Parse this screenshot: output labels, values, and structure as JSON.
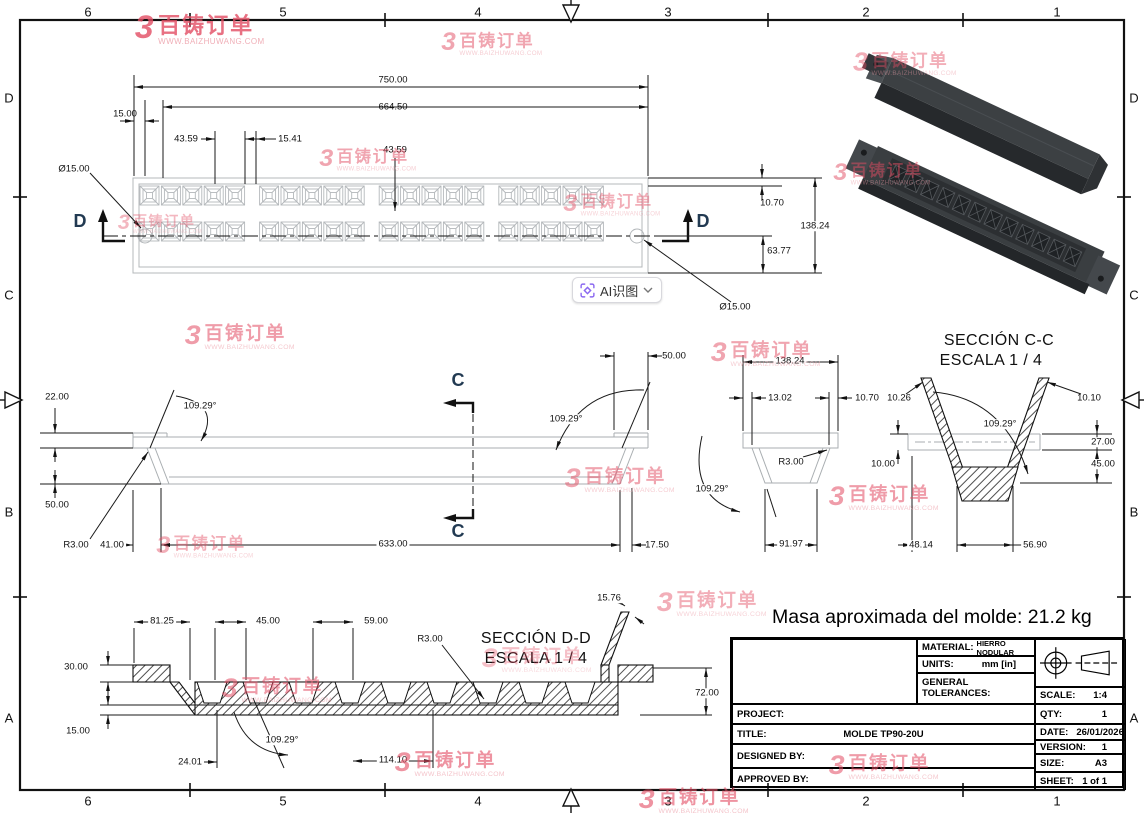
{
  "border": {
    "cols": [
      "6",
      "5",
      "4",
      "3",
      "2",
      "1"
    ],
    "col_x": [
      88,
      283,
      478,
      668,
      866,
      1057
    ],
    "rows": [
      "D",
      "C",
      "B",
      "A"
    ],
    "row_y": [
      98,
      295,
      512,
      718
    ]
  },
  "watermark": {
    "logo": "3",
    "brand": "百铸订单",
    "url": "WWW.BAIZHUWANG.COM",
    "positions": [
      [
        200,
        30,
        1,
        0.8
      ],
      [
        492,
        44,
        0.78,
        0.5
      ],
      [
        905,
        64,
        0.8,
        0.45
      ],
      [
        368,
        160,
        0.75,
        0.5
      ],
      [
        612,
        205,
        0.75,
        0.45
      ],
      [
        882,
        174,
        0.75,
        0.5
      ],
      [
        240,
        337,
        0.85,
        0.55
      ],
      [
        766,
        354,
        0.85,
        0.5
      ],
      [
        620,
        480,
        0.85,
        0.5
      ],
      [
        884,
        498,
        0.85,
        0.55
      ],
      [
        205,
        547,
        0.75,
        0.45
      ],
      [
        712,
        604,
        0.85,
        0.45
      ],
      [
        537,
        660,
        0.85,
        0.35
      ],
      [
        277,
        690,
        0.85,
        0.55
      ],
      [
        450,
        764,
        0.85,
        0.6
      ],
      [
        884,
        767,
        0.85,
        0.55
      ],
      [
        694,
        801,
        0.85,
        0.6
      ],
      [
        160,
        224,
        0.65,
        0.4
      ]
    ]
  },
  "ai_button": {
    "label": "AI识图",
    "icon": "scan-sparkle-icon"
  },
  "mass_note": "Masa aproximada del molde: 21.2 kg",
  "dimensions": [
    {
      "t": "750.00",
      "x": 393,
      "y": 80
    },
    {
      "t": "664.50",
      "x": 393,
      "y": 107
    },
    {
      "t": "15.00",
      "x": 125,
      "y": 114
    },
    {
      "t": "43.59",
      "x": 186,
      "y": 139
    },
    {
      "t": "15.41",
      "x": 290,
      "y": 139
    },
    {
      "t": "43.59",
      "x": 395,
      "y": 150
    },
    {
      "t": "Ø15.00",
      "x": 74,
      "y": 169
    },
    {
      "t": "10.70",
      "x": 772,
      "y": 203
    },
    {
      "t": "138.24",
      "x": 815,
      "y": 226,
      "bg": 1
    },
    {
      "t": "63.77",
      "x": 779,
      "y": 251
    },
    {
      "t": "Ø15.00",
      "x": 735,
      "y": 307
    },
    {
      "t": "D",
      "x": 80,
      "y": 221,
      "cls": "letter"
    },
    {
      "t": "D",
      "x": 703,
      "y": 221,
      "cls": "letter"
    },
    {
      "t": "22.00",
      "x": 57,
      "y": 397
    },
    {
      "t": "109.29°",
      "x": 200,
      "y": 406,
      "bg": 1
    },
    {
      "t": "50.00",
      "x": 57,
      "y": 505
    },
    {
      "t": "R3.00",
      "x": 76,
      "y": 545
    },
    {
      "t": "41.00",
      "x": 112,
      "y": 545,
      "bg": 1
    },
    {
      "t": "633.00",
      "x": 393,
      "y": 544,
      "bg": 1
    },
    {
      "t": "17.50",
      "x": 657,
      "y": 545
    },
    {
      "t": "50.00",
      "x": 674,
      "y": 356
    },
    {
      "t": "109.29°",
      "x": 566,
      "y": 419,
      "bg": 1
    },
    {
      "t": "C",
      "x": 458,
      "y": 380,
      "cls": "letter"
    },
    {
      "t": "C",
      "x": 458,
      "y": 531,
      "cls": "letter"
    },
    {
      "t": "138.24",
      "x": 790,
      "y": 361,
      "bg": 1
    },
    {
      "t": "13.02",
      "x": 780,
      "y": 398
    },
    {
      "t": "10.70",
      "x": 867,
      "y": 398
    },
    {
      "t": "R3.00",
      "x": 791,
      "y": 462,
      "bg": 1
    },
    {
      "t": "109.29°",
      "x": 712,
      "y": 489,
      "bg": 1
    },
    {
      "t": "91.97",
      "x": 791,
      "y": 544,
      "bg": 1
    },
    {
      "t": "SECCIÓN C-C",
      "x": 999,
      "y": 341,
      "cls": "sec"
    },
    {
      "t": "ESCALA 1 / 4",
      "x": 991,
      "y": 361,
      "cls": "sec"
    },
    {
      "t": "10.26",
      "x": 899,
      "y": 398
    },
    {
      "t": "10.10",
      "x": 1089,
      "y": 398
    },
    {
      "t": "109.29°",
      "x": 1000,
      "y": 424,
      "bg": 1
    },
    {
      "t": "27.00",
      "x": 1103,
      "y": 442,
      "bg": 1
    },
    {
      "t": "45.00",
      "x": 1103,
      "y": 464,
      "bg": 1
    },
    {
      "t": "10.00",
      "x": 883,
      "y": 464
    },
    {
      "t": "48.14",
      "x": 921,
      "y": 545,
      "bg": 1
    },
    {
      "t": "56.90",
      "x": 1035,
      "y": 545,
      "bg": 1
    },
    {
      "t": "SECCIÓN D-D",
      "x": 536,
      "y": 639,
      "cls": "sec"
    },
    {
      "t": "ESCALA 1 / 4",
      "x": 536,
      "y": 659,
      "cls": "sec"
    },
    {
      "t": "81.25",
      "x": 162,
      "y": 621,
      "bg": 1
    },
    {
      "t": "45.00",
      "x": 268,
      "y": 621,
      "bg": 1
    },
    {
      "t": "59.00",
      "x": 376,
      "y": 621,
      "bg": 1
    },
    {
      "t": "30.00",
      "x": 76,
      "y": 667
    },
    {
      "t": "15.00",
      "x": 78,
      "y": 731
    },
    {
      "t": "R3.00",
      "x": 430,
      "y": 639,
      "bg": 1
    },
    {
      "t": "15.76",
      "x": 609,
      "y": 598,
      "bg": 1
    },
    {
      "t": "72.00",
      "x": 707,
      "y": 693,
      "bg": 1
    },
    {
      "t": "24.01",
      "x": 190,
      "y": 762
    },
    {
      "t": "109.29°",
      "x": 282,
      "y": 740,
      "bg": 1
    },
    {
      "t": "114.10",
      "x": 393,
      "y": 760,
      "bg": 1
    }
  ],
  "title_block": {
    "material_label": "MATERIAL:",
    "material_value": "HIERRO NODULAR",
    "units_label": "UNITS:",
    "units_value": "mm [in]",
    "tolerances_label": "GENERAL TOLERANCES:",
    "project_label": "PROJECT:",
    "title_label": "TITLE:",
    "title_value": "MOLDE TP90-20U",
    "designed_label": "DESIGNED BY:",
    "approved_label": "APPROVED BY:",
    "scale_label": "SCALE:",
    "scale_value": "1:4",
    "qty_label": "QTY:",
    "qty_value": "1",
    "date_label": "DATE:",
    "date_value": "26/01/2026",
    "version_label": "VERSION:",
    "version_value": "1",
    "size_label": "SIZE:",
    "size_value": "A3",
    "sheet_label": "SHEET:",
    "sheet_value": "1 of 1"
  }
}
